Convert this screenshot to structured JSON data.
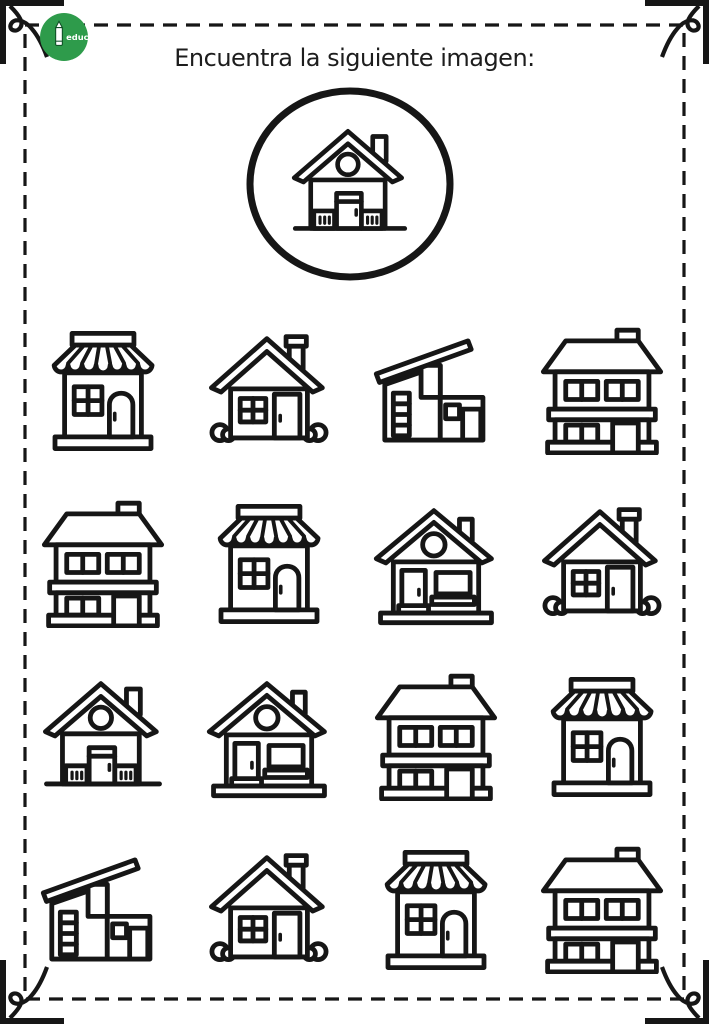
{
  "page": {
    "background": "#ffffff",
    "ink_color": "#161616",
    "border_style": "dashed-rectangle-with-corner-flourishes"
  },
  "logo": {
    "name": "educar-logo",
    "bg_color": "#2e9b4b",
    "text": "educar"
  },
  "header": {
    "title": "Encuentra la siguiente imagen:"
  },
  "target": {
    "description": "house with round attic window, central door and two slatted vent panels on a ground line, chimney on right roof slope",
    "symbol": "#sym-target"
  },
  "grid": {
    "rows": 4,
    "cols": 4,
    "cells": [
      {
        "id": 1,
        "type": "shop-with-awning",
        "symbol": "#sym-shop",
        "is_match": false
      },
      {
        "id": 2,
        "type": "simple-house-with-bushes",
        "symbol": "#sym-simple",
        "is_match": false
      },
      {
        "id": 3,
        "type": "modern-shed-roof-house",
        "symbol": "#sym-modern",
        "is_match": false
      },
      {
        "id": 4,
        "type": "two-story-house",
        "symbol": "#sym-twostory",
        "is_match": false
      },
      {
        "id": 5,
        "type": "two-story-house",
        "symbol": "#sym-twostory",
        "is_match": false
      },
      {
        "id": 6,
        "type": "shop-with-awning",
        "symbol": "#sym-shop",
        "is_match": false
      },
      {
        "id": 7,
        "type": "round-window-house-with-porch",
        "symbol": "#sym-porch",
        "is_match": false
      },
      {
        "id": 8,
        "type": "simple-house-with-bushes",
        "symbol": "#sym-simple",
        "is_match": false
      },
      {
        "id": 9,
        "type": "target-house",
        "symbol": "#sym-target",
        "is_match": true
      },
      {
        "id": 10,
        "type": "round-window-house-with-porch",
        "symbol": "#sym-porch",
        "is_match": false
      },
      {
        "id": 11,
        "type": "two-story-house",
        "symbol": "#sym-twostory",
        "is_match": false
      },
      {
        "id": 12,
        "type": "shop-with-awning",
        "symbol": "#sym-shop",
        "is_match": false
      },
      {
        "id": 13,
        "type": "modern-shed-roof-house",
        "symbol": "#sym-modern",
        "is_match": false
      },
      {
        "id": 14,
        "type": "simple-house-with-bushes",
        "symbol": "#sym-simple",
        "is_match": false
      },
      {
        "id": 15,
        "type": "shop-with-awning",
        "symbol": "#sym-shop",
        "is_match": false
      },
      {
        "id": 16,
        "type": "two-story-house",
        "symbol": "#sym-twostory",
        "is_match": false
      }
    ]
  }
}
